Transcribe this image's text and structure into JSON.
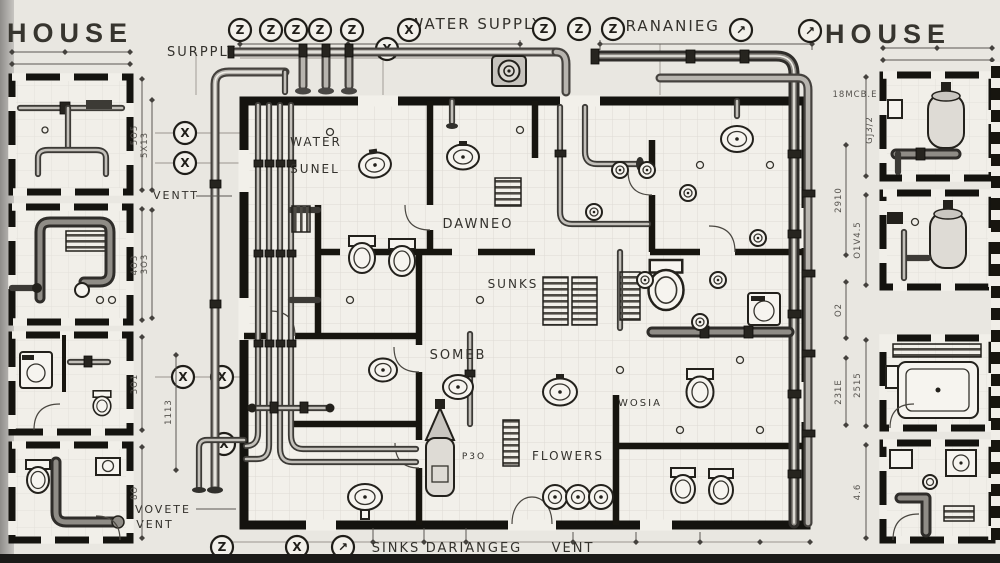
{
  "titles": {
    "left": "HOUSE",
    "right": "HOUSE"
  },
  "labels": {
    "supply": "SURPPLY",
    "water_supply": "WATER SUPPLY",
    "drainage": "DRANANIEG",
    "water": "WATER",
    "sunel": "SUNEL",
    "dawneo": "DAWNEO",
    "sunks": "SUNKS",
    "someb": "SOMEB",
    "flowers": "FLOWERS",
    "wosia": "WOSIA",
    "p30": "P3O",
    "ventt": "VENTT",
    "vovete": "VOVETE",
    "vent_small": "VENT",
    "sinks": "SINKS",
    "dariangeg": "DARIANGEG",
    "vent": "VENT"
  },
  "symbols": {
    "z": "Z",
    "x": "X",
    "arrow": "↗"
  },
  "dimensions": {
    "left_top": "5X13",
    "left_mid": "3O3",
    "left_bot": "1113",
    "plan_right_top": "2910",
    "plan_right_mid": "O2",
    "plan_right_bot": "231E",
    "rc1_a": "18MCB.E",
    "rc1_b": "GJ3/2",
    "rc2": "O1V4.5",
    "rc3": "2515",
    "rc4": "4.6",
    "lc1": "5O5",
    "lc2": "4O3",
    "lc3": "3O1",
    "lc4": "8O"
  },
  "colors": {
    "paper": "#eceae5",
    "ink": "#1d1c1a",
    "pipe_dark": "#45423e",
    "pipe_light": "#d8d5d0",
    "grid": "#cbc8c2",
    "dim": "#5a5752"
  }
}
